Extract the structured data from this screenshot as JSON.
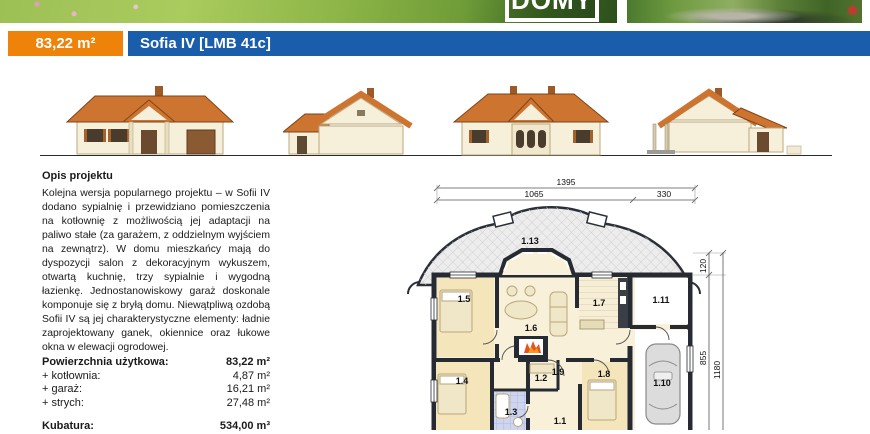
{
  "header": {
    "logo_text": "DOMY",
    "area_badge": "83,22 m²",
    "title": "Sofia IV [LMB 41c]"
  },
  "description": {
    "heading": "Opis projektu",
    "body": "Kolejna wersja popularnego projektu – w Sofii IV dodano sypialnię i przewidziano pomieszczenia na kotłownię z możliwością jej adaptacji na paliwo stałe (za garażem, z oddzielnym wyjściem na zewnątrz). W domu mieszkańcy mają do dyspozycji salon z dekoracyjnym wykuszem, otwartą kuchnię, trzy sypialnie i wygodną łazienkę. Jednostanowiskowy garaż doskonale komponuje się z bryłą domu. Niewątpliwą ozdobą Sofii IV są jej charakterystyczne elementy: ładnie zaprojektowany ganek, okiennice oraz łukowe okna w elewacji ogrodowej."
  },
  "areas": {
    "rows": [
      {
        "label": "Powierzchnia użytkowa:",
        "value": "83,22 m²"
      },
      {
        "label": "+ kotłownia:",
        "value": "4,87 m²"
      },
      {
        "label": "+ garaż:",
        "value": "16,21 m²"
      },
      {
        "label": "+ strych:",
        "value": "27,48 m²"
      }
    ],
    "kubatura": {
      "label": "Kubatura:",
      "value": "534,00 m³"
    }
  },
  "plan": {
    "dims": {
      "w_total": "1395",
      "w_left": "1065",
      "w_right": "330",
      "d_bay": "120",
      "d_main": "855",
      "d_total": "1180"
    },
    "rooms": {
      "r1": "1.1",
      "r2": "1.2",
      "r3": "1.3",
      "r4": "1.4",
      "r5": "1.5",
      "r6": "1.6",
      "r7": "1.7",
      "r8": "1.8",
      "r9": "1.9",
      "r10": "1.10",
      "r11": "1.11",
      "r13": "1.13"
    }
  },
  "colors": {
    "accent_orange": "#ef830a",
    "accent_blue": "#1a5dab",
    "roof_orange": "#cd7431",
    "wall_cream": "#f6efda",
    "plan_wall": "#262b33",
    "plan_room_beige": "#f5e5ba",
    "plan_bath_blue": "#cfd5ee",
    "plan_terrace_gray": "#ededed"
  }
}
